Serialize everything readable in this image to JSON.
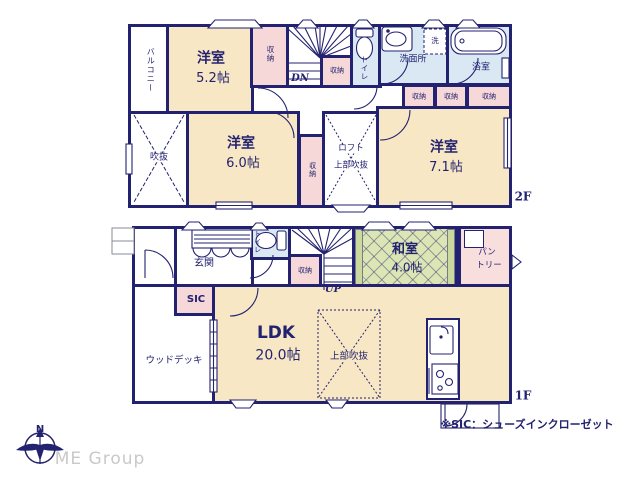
{
  "colors": {
    "wall": "#232270",
    "room_cream": "#f7e7c4",
    "closet_pink": "#f6d8d8",
    "wet_blue": "#d9e8f3",
    "tatami_green": "#dce6b4",
    "muted_gray": "#c9c9c9"
  },
  "floor2": {
    "label": "2F",
    "balcony": "バルコニー",
    "room_52_name": "洋室",
    "room_52_size": "5.2帖",
    "room_60_name": "洋室",
    "room_60_size": "6.0帖",
    "room_71_name": "洋室",
    "room_71_size": "7.1帖",
    "closet": "収納",
    "toilet": "トイレ",
    "washroom": "洗面所",
    "laundry": "洗",
    "bath": "浴室",
    "void": "吹抜",
    "loft_line1": "ロフト",
    "loft_line2": "上部吹抜",
    "down": "DN"
  },
  "floor1": {
    "label": "1F",
    "entrance": "玄関",
    "sic": "SIC",
    "toilet": "トイレ",
    "closet": "収納",
    "up": "UP",
    "washitsu_name": "和室",
    "washitsu_size": "4.0帖",
    "pantry_line1": "パン",
    "pantry_line2": "トリー",
    "wood_deck": "ウッドデッキ",
    "ldk_name": "LDK",
    "ldk_size": "20.0帖",
    "void_above": "上部吹抜"
  },
  "note": "※SIC：シューズインクローゼット",
  "footer": {
    "company": "ME Group",
    "compass_n": "N"
  }
}
